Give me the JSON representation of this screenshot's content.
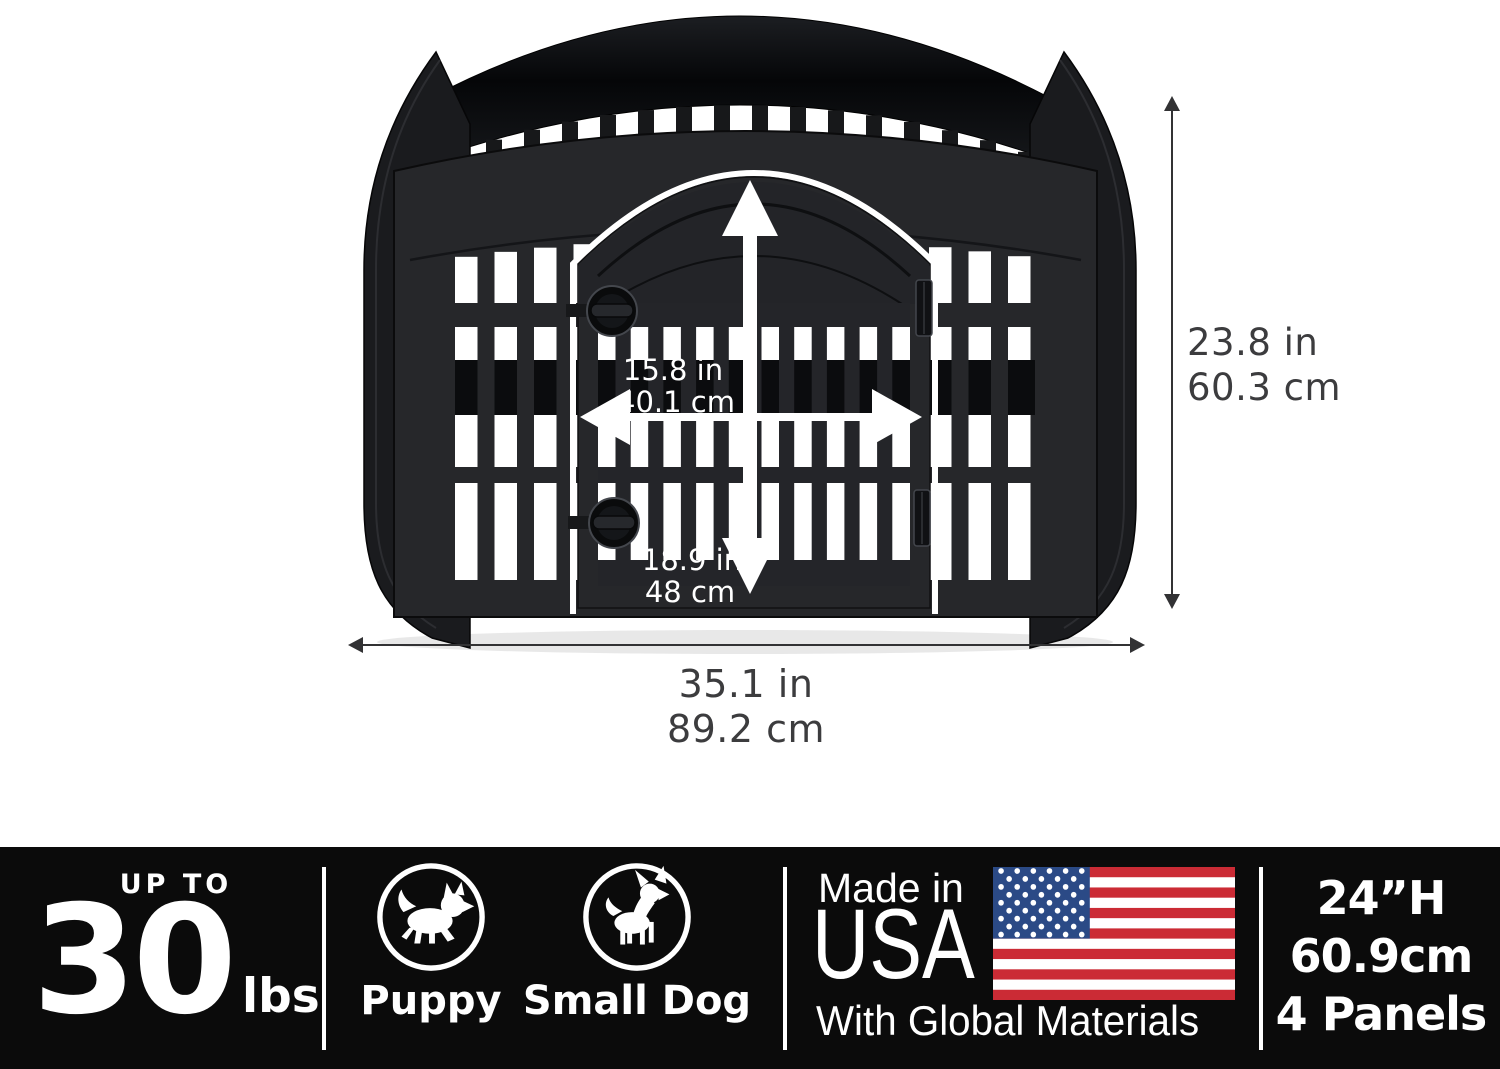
{
  "product_diagram": {
    "door": {
      "width_in": "15.8 in",
      "width_cm": "40.1 cm",
      "height_in": "18.9 in",
      "height_cm": "48 cm"
    },
    "pen": {
      "height_in": "23.8 in",
      "height_cm": "60.3 cm",
      "width_in": "35.1 in",
      "width_cm": "89.2 cm"
    }
  },
  "banner": {
    "weight_limit": {
      "prefix": "UP TO",
      "value": "30",
      "unit": "lbs"
    },
    "pets": [
      {
        "label": "Puppy",
        "icon": "puppy-icon"
      },
      {
        "label": "Small Dog",
        "icon": "small-dog-icon"
      }
    ],
    "origin": {
      "line1": "Made in",
      "line2": "USA",
      "line3": "With Global Materials",
      "flag_icon": "us-flag-icon"
    },
    "specs": {
      "height": "24”H",
      "height_metric": "60.9cm",
      "panels": "4 Panels"
    }
  },
  "colors": {
    "banner_bg": "#0b0b0b",
    "pen_body": "#26272a",
    "pen_dark_band": "#0b0c0e",
    "flag_red": "#cb2b35",
    "flag_blue": "#2b4a86",
    "dimension_text": "#3c3c3e",
    "white": "#ffffff"
  }
}
